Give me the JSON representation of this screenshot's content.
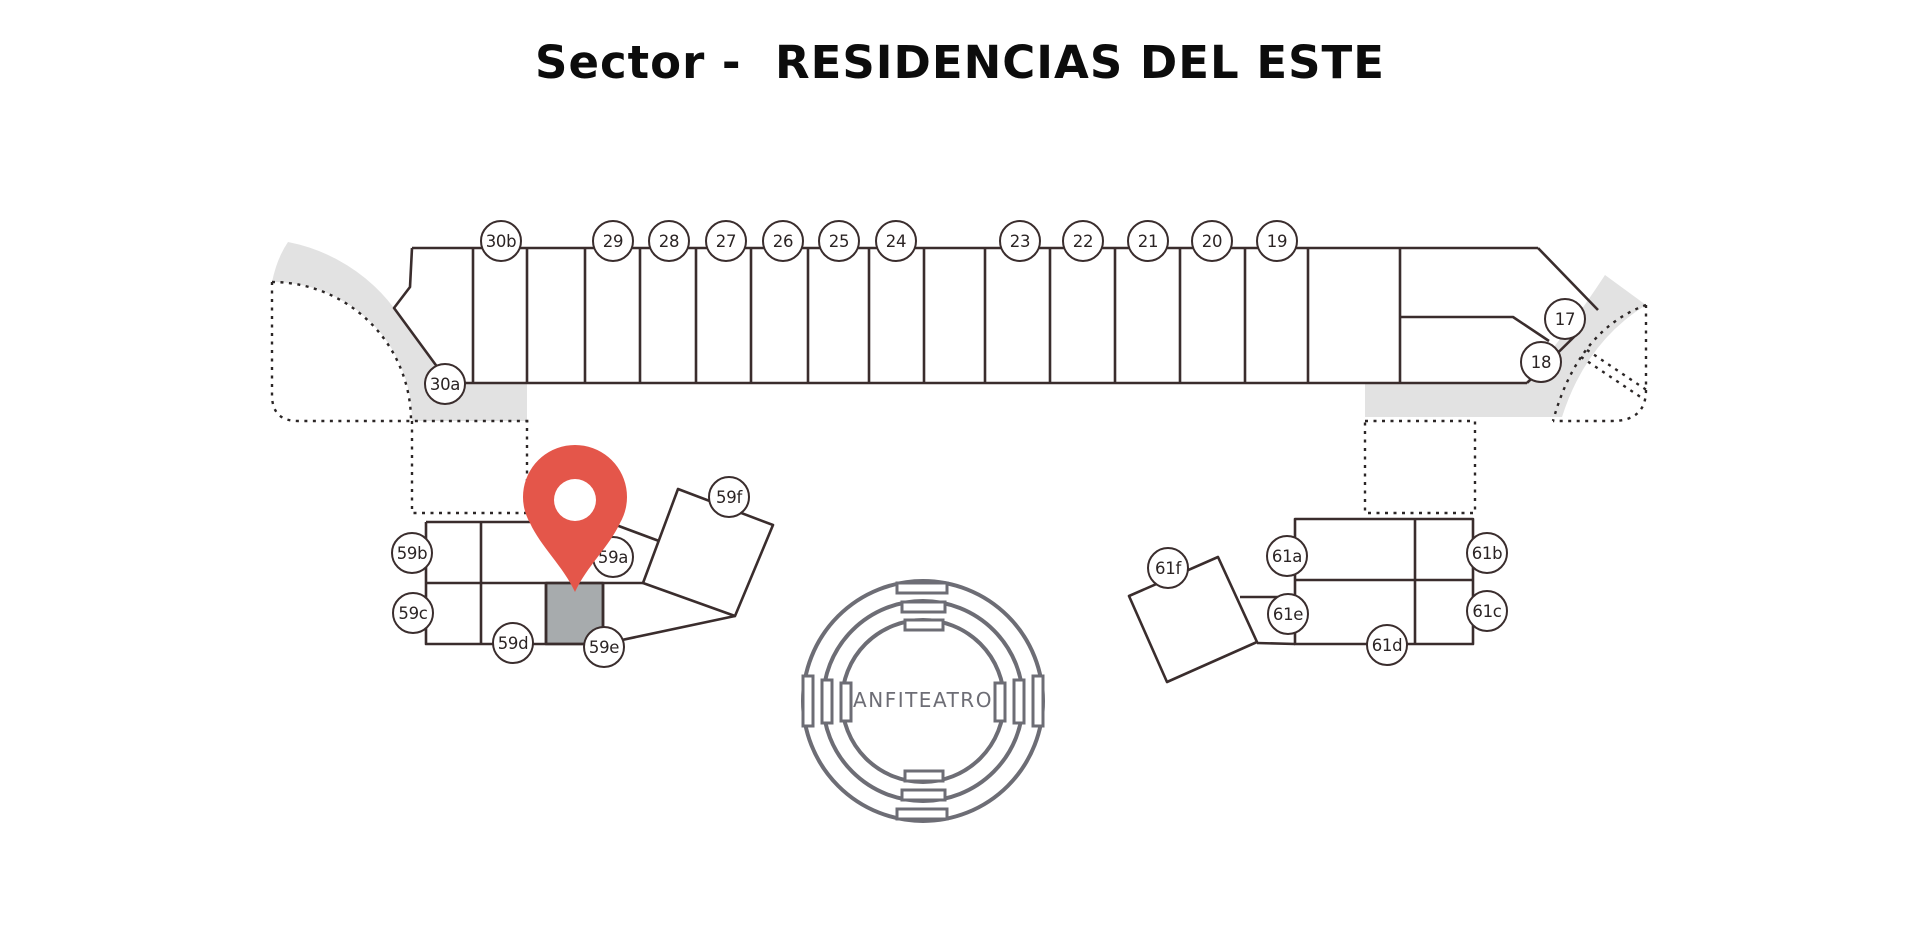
{
  "title": "Sector -  RESIDENCIAS DEL ESTE",
  "amphitheater": {
    "label": "ANFITEATRO"
  },
  "lots": {
    "north_row": [
      "30b",
      "29",
      "28",
      "27",
      "26",
      "25",
      "24",
      "23",
      "22",
      "21",
      "20",
      "19"
    ],
    "north_row_west": [
      "30a"
    ],
    "north_row_east": [
      "17",
      "18"
    ],
    "west_cluster": [
      "59a",
      "59b",
      "59c",
      "59d",
      "59e",
      "59f"
    ],
    "east_cluster": [
      "61a",
      "61b",
      "61c",
      "61d",
      "61e",
      "61f"
    ]
  },
  "pin": {
    "icon": "location-pin",
    "color": "#e4564a"
  },
  "colors": {
    "line": "#3a2d2d",
    "dotted_line": "#2b2626",
    "road": "#e2e2e2",
    "highlighted_cell": "#a7abad",
    "amphitheater": "#6d6d75",
    "pin": "#e4564a"
  }
}
